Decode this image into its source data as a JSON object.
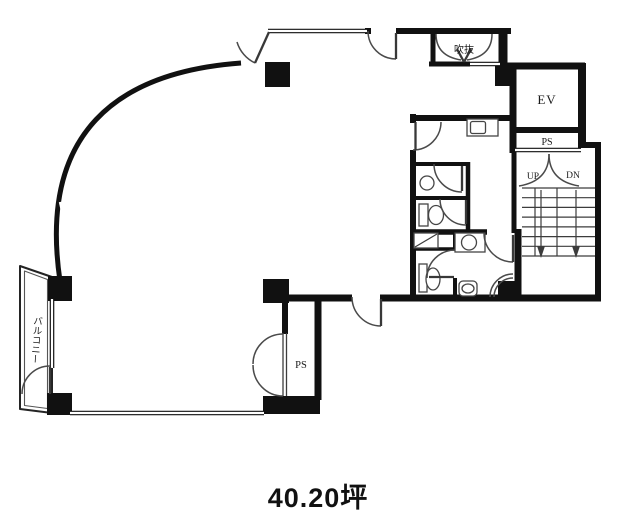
{
  "floor_plan": {
    "area_label": "40.20坪",
    "labels": {
      "elevator": "EV",
      "pipe_space_upper": "PS",
      "pipe_space_closet": "PS",
      "atrium": "吹抜",
      "balcony": "バルコニー",
      "stairs_up": "UP",
      "stairs_down": "DN"
    },
    "colors": {
      "wall": "#111111",
      "line": "#4a4a4a",
      "background": "#ffffff",
      "text": "#1a1a1a"
    }
  }
}
